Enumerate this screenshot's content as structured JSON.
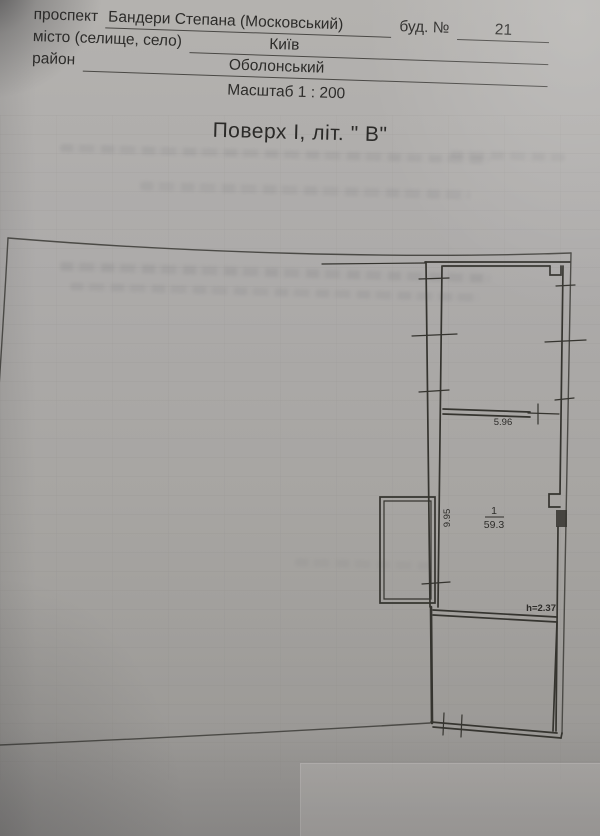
{
  "document": {
    "header": {
      "row1": {
        "label": "проспект",
        "value": "Бандери Степана (Московський)",
        "label2": "буд. №",
        "value2": "21"
      },
      "row2": {
        "label": "місто (селище, село)",
        "value": "Київ"
      },
      "row3": {
        "label": "район",
        "value": "Оболонський"
      },
      "scale_line": "Масштаб 1 : 200"
    },
    "title": "Поверх І, літ. \" В\"",
    "plan": {
      "dimensions": {
        "top_room_width": "5.96",
        "main_room_depth": "9.95",
        "ceiling_height": "h=2.37"
      },
      "rooms": [
        {
          "number": "1",
          "area": "59.3"
        }
      ]
    },
    "colors": {
      "paper": "#aba9a6",
      "ink": "#2d2c29",
      "wall_line": "#35342f",
      "outline": "#4b4a46"
    }
  }
}
